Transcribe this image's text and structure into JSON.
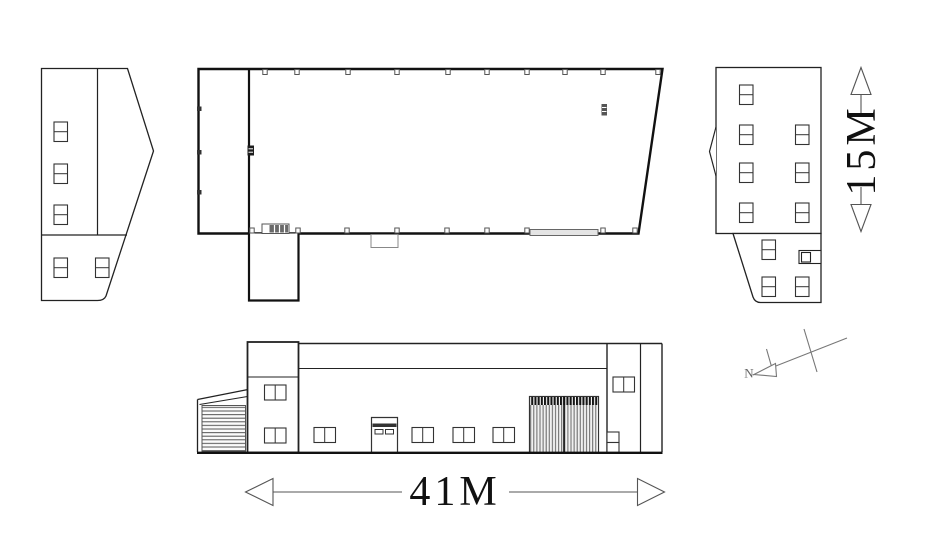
{
  "labels": {
    "width_dimension": "41M",
    "height_dimension": "15M",
    "north": "N"
  },
  "style": {
    "background": "#ffffff",
    "line_color": "#222222",
    "thick_line_color": "#111111",
    "dimension_color": "#4a4a4a",
    "text_color": "#111111"
  }
}
